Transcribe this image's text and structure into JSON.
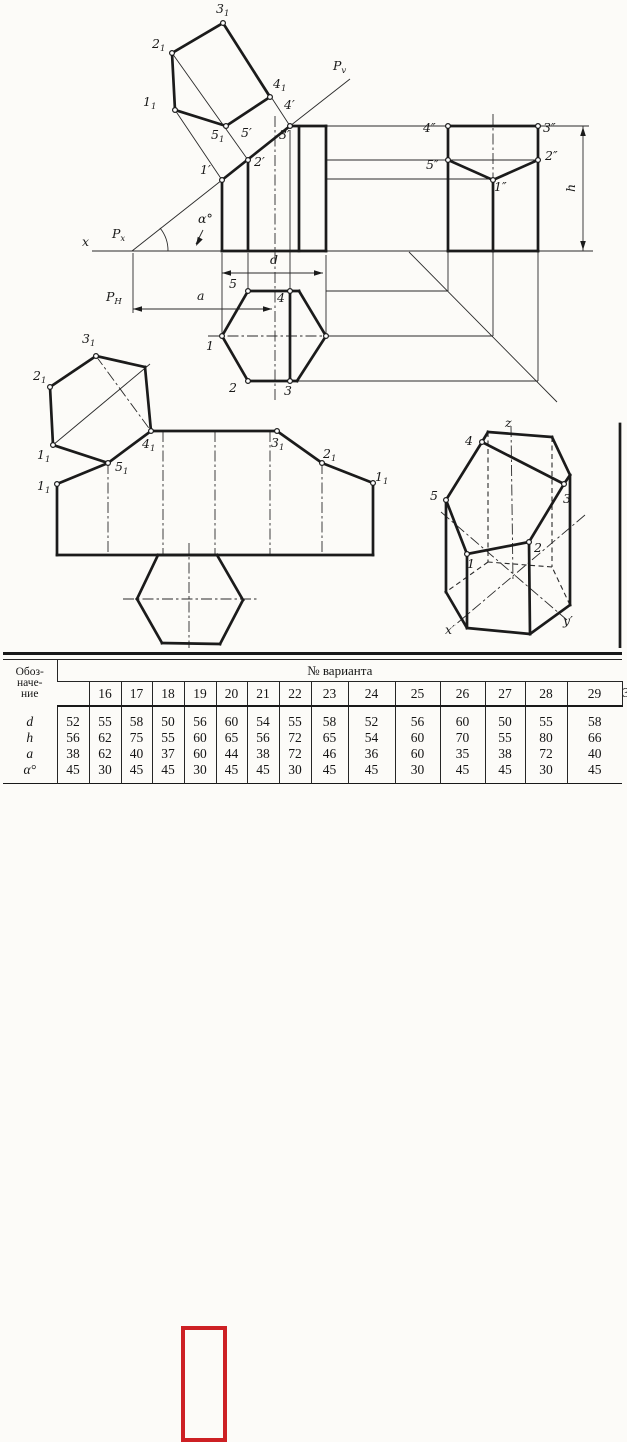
{
  "page": {
    "ink": "#1b1b1b",
    "paper": "#fcfbf8",
    "highlight_red": "#cd2024"
  },
  "table": {
    "header_col_label_lines": [
      "Обоз-",
      "наче-",
      "ние"
    ],
    "span_header": "№ варианта",
    "variants": [
      "16",
      "17",
      "18",
      "19",
      "20",
      "21",
      "22",
      "23",
      "24",
      "25",
      "26",
      "27",
      "28",
      "29",
      "30"
    ],
    "rows": [
      {
        "label": "d",
        "values": [
          "52",
          "55",
          "58",
          "50",
          "56",
          "60",
          "54",
          "55",
          "58",
          "52",
          "56",
          "60",
          "50",
          "55",
          "58"
        ]
      },
      {
        "label": "h",
        "values": [
          "56",
          "62",
          "75",
          "55",
          "60",
          "65",
          "56",
          "72",
          "65",
          "54",
          "60",
          "70",
          "55",
          "80",
          "66"
        ]
      },
      {
        "label": "a",
        "values": [
          "38",
          "62",
          "40",
          "37",
          "60",
          "44",
          "38",
          "72",
          "46",
          "36",
          "60",
          "35",
          "38",
          "72",
          "40"
        ]
      },
      {
        "label": "α°",
        "values": [
          "45",
          "30",
          "45",
          "45",
          "30",
          "45",
          "45",
          "30",
          "45",
          "45",
          "30",
          "45",
          "45",
          "30",
          "45"
        ]
      }
    ],
    "highlighted_variant": "20"
  },
  "drawing": {
    "thick": [
      [
        222,
        251,
        326,
        251
      ],
      [
        222,
        251,
        222,
        180
      ],
      [
        222,
        180,
        290,
        126
      ],
      [
        290,
        126,
        326,
        126
      ],
      [
        326,
        126,
        326,
        251
      ],
      [
        248,
        251,
        248,
        160
      ],
      [
        299,
        251,
        299,
        127
      ],
      [
        448,
        126,
        538,
        126
      ],
      [
        448,
        126,
        448,
        251
      ],
      [
        538,
        126,
        538,
        251
      ],
      [
        448,
        251,
        538,
        251
      ],
      [
        493,
        180,
        493,
        251
      ],
      [
        448,
        160,
        493,
        180
      ],
      [
        493,
        180,
        538,
        160
      ],
      [
        222,
        336,
        248,
        291
      ],
      [
        248,
        291,
        299,
        291
      ],
      [
        299,
        291,
        326,
        336
      ],
      [
        326,
        336,
        297,
        381
      ],
      [
        297,
        381,
        248,
        381
      ],
      [
        248,
        381,
        222,
        336
      ],
      [
        290,
        291,
        290,
        381
      ],
      [
        175,
        110,
        172,
        53
      ],
      [
        172,
        53,
        223,
        23
      ],
      [
        223,
        23,
        270,
        97
      ],
      [
        270,
        97,
        226,
        126
      ],
      [
        226,
        126,
        175,
        110
      ],
      [
        57,
        484,
        57,
        555
      ],
      [
        57,
        555,
        373,
        555
      ],
      [
        373,
        555,
        373,
        483
      ],
      [
        373,
        483,
        322,
        463
      ],
      [
        322,
        463,
        277,
        431
      ],
      [
        277,
        431,
        151,
        431
      ],
      [
        151,
        431,
        108,
        463
      ],
      [
        108,
        463,
        57,
        484
      ],
      [
        108,
        463,
        53,
        445
      ],
      [
        53,
        445,
        50,
        387
      ],
      [
        50,
        387,
        96,
        356
      ],
      [
        96,
        356,
        145,
        367
      ],
      [
        145,
        367,
        151,
        431
      ],
      [
        158,
        555,
        217,
        555
      ],
      [
        217,
        555,
        243,
        600
      ],
      [
        243,
        600,
        220,
        644
      ],
      [
        220,
        644,
        162,
        643
      ],
      [
        162,
        643,
        137,
        599
      ],
      [
        137,
        599,
        158,
        555
      ],
      [
        467,
        554,
        529,
        542
      ],
      [
        529,
        542,
        564,
        484
      ],
      [
        564,
        484,
        482,
        442
      ],
      [
        482,
        442,
        446,
        500
      ],
      [
        446,
        500,
        467,
        554
      ],
      [
        482,
        442,
        488,
        432
      ],
      [
        488,
        432,
        552,
        437
      ],
      [
        552,
        437,
        570,
        475
      ],
      [
        570,
        475,
        564,
        484
      ],
      [
        446,
        500,
        446,
        592
      ],
      [
        467,
        554,
        467,
        628
      ],
      [
        529,
        542,
        530,
        634
      ],
      [
        570,
        475,
        570,
        605
      ],
      [
        446,
        592,
        467,
        628
      ],
      [
        467,
        628,
        530,
        634
      ],
      [
        530,
        634,
        570,
        605
      ],
      [
        620,
        424,
        620,
        656
      ]
    ],
    "thin": [
      [
        92,
        251,
        593,
        251
      ],
      [
        132,
        251,
        222,
        180
      ],
      [
        290,
        126,
        350,
        79
      ],
      [
        326,
        126,
        589,
        126
      ],
      [
        326,
        160,
        538,
        160
      ],
      [
        326,
        179,
        493,
        179
      ],
      [
        409,
        252,
        557,
        402
      ],
      [
        326,
        291,
        448,
        291
      ],
      [
        448,
        291,
        448,
        252
      ],
      [
        326,
        336,
        493,
        336
      ],
      [
        493,
        336,
        493,
        252
      ],
      [
        298,
        381,
        538,
        381
      ],
      [
        538,
        381,
        538,
        252
      ],
      [
        222,
        253,
        222,
        333
      ],
      [
        248,
        253,
        248,
        288
      ],
      [
        290,
        130,
        290,
        288
      ],
      [
        326,
        255,
        326,
        333
      ],
      [
        222,
        180,
        175,
        110
      ],
      [
        248,
        160,
        172,
        53
      ],
      [
        290,
        126,
        223,
        23
      ],
      [
        53,
        445,
        150,
        364
      ],
      [
        222,
        273,
        323,
        273
      ],
      [
        133,
        309,
        272,
        309
      ],
      [
        583,
        126,
        583,
        251
      ],
      [
        133,
        253,
        133,
        313
      ],
      [
        203,
        230,
        196,
        244
      ]
    ],
    "dash": [
      [
        570,
        605,
        552,
        567
      ],
      [
        552,
        567,
        488,
        562
      ],
      [
        488,
        562,
        446,
        592
      ],
      [
        488,
        432,
        488,
        562
      ],
      [
        552,
        437,
        552,
        567
      ]
    ],
    "axis": [
      [
        275,
        116,
        275,
        402
      ],
      [
        493,
        114,
        493,
        180
      ],
      [
        208,
        336,
        326,
        336
      ],
      [
        108,
        463,
        108,
        555
      ],
      [
        163,
        431,
        163,
        555
      ],
      [
        215,
        431,
        215,
        555
      ],
      [
        270,
        431,
        270,
        555
      ],
      [
        322,
        463,
        322,
        555
      ],
      [
        96,
        356,
        151,
        431
      ],
      [
        151,
        431,
        108,
        463
      ],
      [
        123,
        599,
        257,
        599
      ],
      [
        189,
        543,
        189,
        657
      ],
      [
        511,
        426,
        513,
        582
      ],
      [
        585,
        515,
        455,
        625
      ],
      [
        441,
        512,
        567,
        620
      ]
    ],
    "paths": [
      "M 168,251 A 36,36 0 0 0 160,228"
    ],
    "arrows": [
      {
        "x": 222,
        "y": 273,
        "a": 180
      },
      {
        "x": 323,
        "y": 273,
        "a": 0
      },
      {
        "x": 133,
        "y": 309,
        "a": 180
      },
      {
        "x": 272,
        "y": 309,
        "a": 0
      },
      {
        "x": 583,
        "y": 127,
        "a": -90
      },
      {
        "x": 583,
        "y": 250,
        "a": 90
      },
      {
        "x": 196,
        "y": 246,
        "a": 118
      }
    ],
    "circles": [
      [
        222,
        180
      ],
      [
        248,
        160
      ],
      [
        290,
        126
      ],
      [
        222,
        336
      ],
      [
        248,
        291
      ],
      [
        290,
        291
      ],
      [
        326,
        336
      ],
      [
        290,
        381
      ],
      [
        248,
        381
      ],
      [
        448,
        126
      ],
      [
        538,
        126
      ],
      [
        448,
        160
      ],
      [
        538,
        160
      ],
      [
        493,
        180
      ],
      [
        175,
        110
      ],
      [
        172,
        53
      ],
      [
        223,
        23
      ],
      [
        270,
        97
      ],
      [
        226,
        126
      ],
      [
        57,
        484
      ],
      [
        108,
        463
      ],
      [
        151,
        431
      ],
      [
        277,
        431
      ],
      [
        322,
        463
      ],
      [
        373,
        483
      ],
      [
        53,
        445
      ],
      [
        50,
        387
      ],
      [
        96,
        356
      ],
      [
        467,
        554
      ],
      [
        529,
        542
      ],
      [
        564,
        484
      ],
      [
        482,
        442
      ],
      [
        446,
        500
      ]
    ],
    "labels": [
      {
        "t": "3",
        "s": "1",
        "x": 216,
        "y": 13
      },
      {
        "t": "2",
        "s": "1",
        "x": 152,
        "y": 48
      },
      {
        "t": "1",
        "s": "1",
        "x": 143,
        "y": 106
      },
      {
        "t": "5",
        "s": "1",
        "x": 211,
        "y": 139
      },
      {
        "t": "4",
        "s": "1",
        "x": 273,
        "y": 88
      },
      {
        "t": "P",
        "s": "v",
        "x": 333,
        "y": 70
      },
      {
        "t": "4′",
        "s": "",
        "x": 284,
        "y": 109
      },
      {
        "t": "3′",
        "s": "",
        "x": 279,
        "y": 139
      },
      {
        "t": "5′",
        "s": "",
        "x": 241,
        "y": 137
      },
      {
        "t": "2′",
        "s": "",
        "x": 254,
        "y": 166
      },
      {
        "t": "1′",
        "s": "",
        "x": 200,
        "y": 174
      },
      {
        "t": "α°",
        "s": "",
        "x": 198,
        "y": 223
      },
      {
        "t": "x",
        "s": "",
        "x": 82,
        "y": 246
      },
      {
        "t": "P",
        "s": "x",
        "x": 112,
        "y": 238
      },
      {
        "t": "P",
        "s": "H",
        "x": 106,
        "y": 301
      },
      {
        "t": "a",
        "s": "",
        "x": 197,
        "y": 300
      },
      {
        "t": "d",
        "s": "",
        "x": 270,
        "y": 264
      },
      {
        "t": "5",
        "s": "",
        "x": 229,
        "y": 288
      },
      {
        "t": "4",
        "s": "",
        "x": 277,
        "y": 302
      },
      {
        "t": "1",
        "s": "",
        "x": 206,
        "y": 350
      },
      {
        "t": "2",
        "s": "",
        "x": 229,
        "y": 392
      },
      {
        "t": "3",
        "s": "",
        "x": 284,
        "y": 395
      },
      {
        "t": "4″",
        "s": "",
        "x": 423,
        "y": 132
      },
      {
        "t": "3″",
        "s": "",
        "x": 543,
        "y": 132
      },
      {
        "t": "5″",
        "s": "",
        "x": 426,
        "y": 169
      },
      {
        "t": "2″",
        "s": "",
        "x": 545,
        "y": 160
      },
      {
        "t": "1″",
        "s": "",
        "x": 494,
        "y": 191
      },
      {
        "t": "h",
        "s": "",
        "x": 575,
        "y": 192,
        "r": -90
      },
      {
        "t": "2",
        "s": "1",
        "x": 33,
        "y": 380
      },
      {
        "t": "3",
        "s": "1",
        "x": 82,
        "y": 343
      },
      {
        "t": "1",
        "s": "1",
        "x": 37,
        "y": 459
      },
      {
        "t": "1",
        "s": "1",
        "x": 37,
        "y": 490
      },
      {
        "t": "5",
        "s": "1",
        "x": 115,
        "y": 471
      },
      {
        "t": "4",
        "s": "1",
        "x": 142,
        "y": 448
      },
      {
        "t": "3",
        "s": "1",
        "x": 271,
        "y": 447
      },
      {
        "t": "2",
        "s": "1",
        "x": 323,
        "y": 458
      },
      {
        "t": "1",
        "s": "1",
        "x": 375,
        "y": 481
      },
      {
        "t": "z",
        "s": "",
        "x": 505,
        "y": 427
      },
      {
        "t": "4",
        "s": "",
        "x": 465,
        "y": 445
      },
      {
        "t": "5",
        "s": "",
        "x": 430,
        "y": 500
      },
      {
        "t": "3",
        "s": "",
        "x": 563,
        "y": 503
      },
      {
        "t": "1",
        "s": "",
        "x": 467,
        "y": 568
      },
      {
        "t": "2",
        "s": "",
        "x": 534,
        "y": 552
      },
      {
        "t": "x′",
        "s": "",
        "x": 445,
        "y": 634
      },
      {
        "t": "y′",
        "s": "",
        "x": 563,
        "y": 625
      }
    ]
  }
}
